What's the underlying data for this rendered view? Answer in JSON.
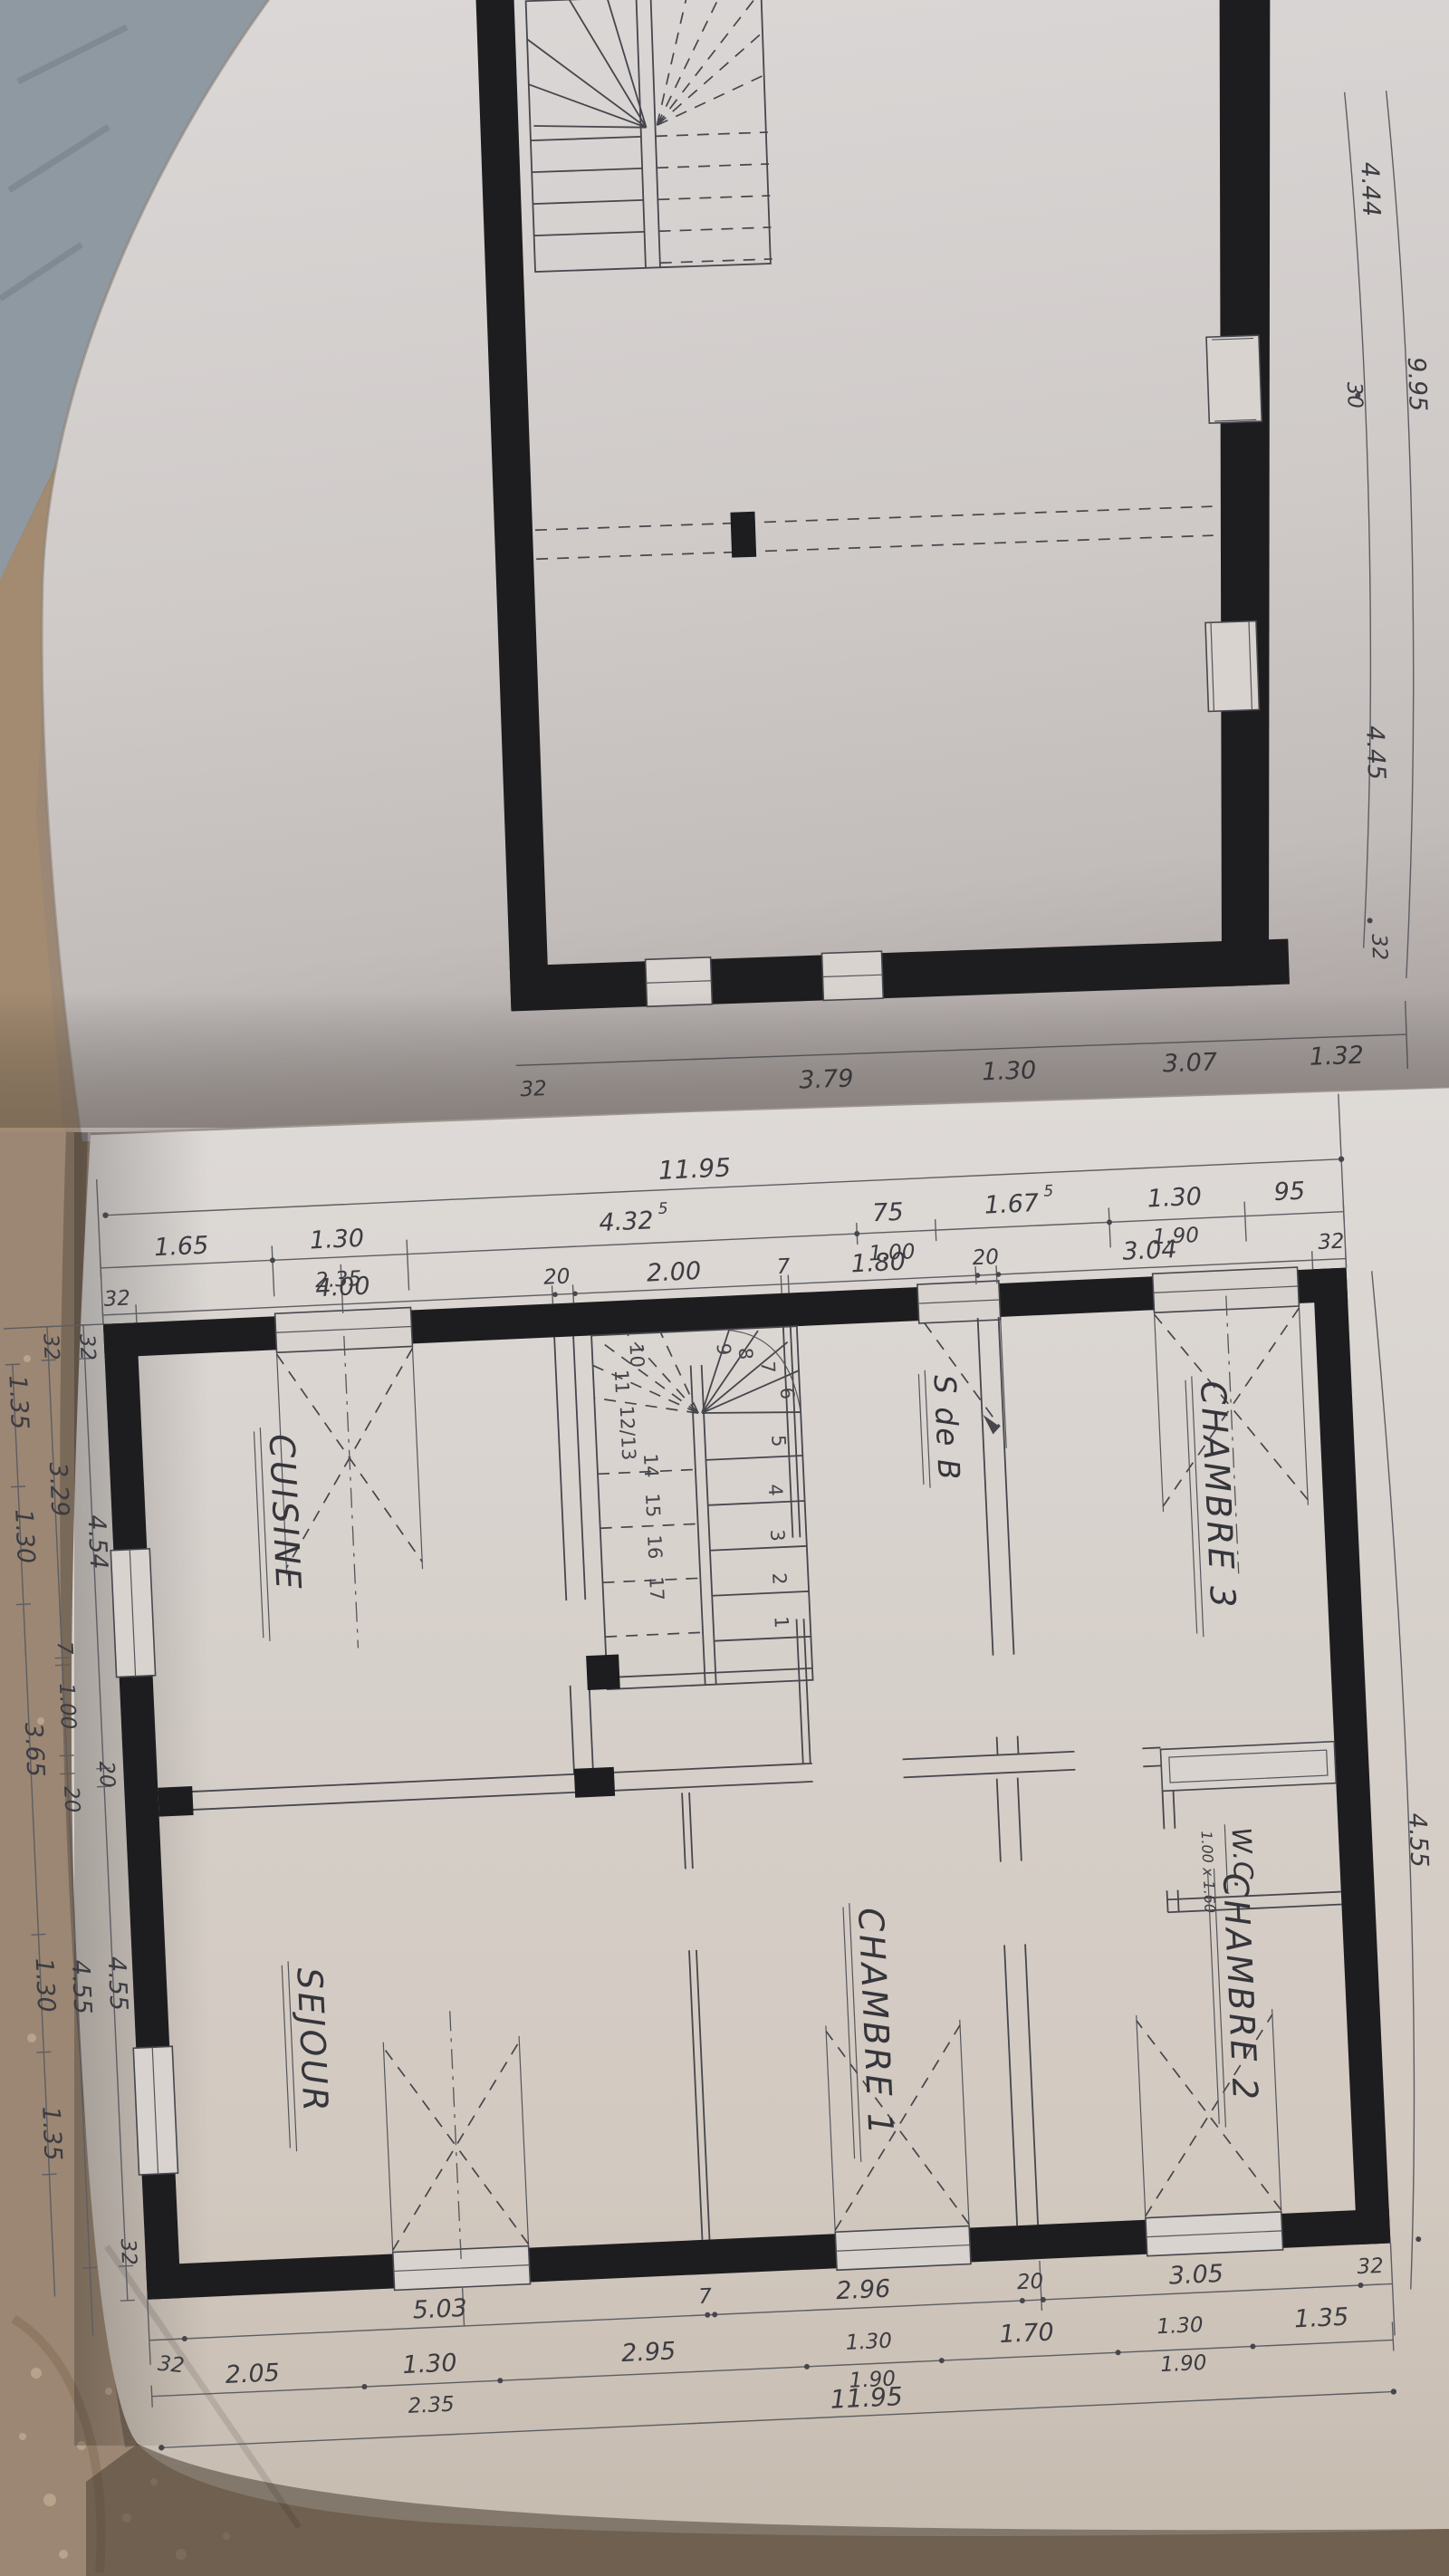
{
  "palette": {
    "paper": "#d8d3cf",
    "ink": "#3c3c42",
    "wall_black": "#1d1d1f",
    "carpet_tan": "#9b8773",
    "carpet_blue": "#8e99a2"
  },
  "upper_plan": {
    "right_dims": [
      "4.44",
      "30",
      "4.45",
      "32"
    ],
    "right_total": "9.95",
    "bottom_dims": [
      "32",
      "3.79",
      "1.30",
      "3.07",
      "1.32"
    ]
  },
  "plan": {
    "top_total": "11.95",
    "bottom_total": "11.95",
    "top_row2": [
      {
        "t": "1.65"
      },
      {
        "t": "1.30",
        "b": "2.35"
      },
      {
        "t": "4.32",
        "sup": "5"
      },
      {
        "t": "75",
        "b": "1.00"
      },
      {
        "t": "1.67",
        "sup": "5"
      },
      {
        "t": "1.30",
        "b": "1.90"
      },
      {
        "t": "95"
      }
    ],
    "top_row3": [
      "32",
      "4.00",
      "20",
      "2.00",
      "7",
      "1.80",
      "20",
      "3.04",
      "32"
    ],
    "bottom_row1": [
      "32",
      "5.03",
      "7",
      "2.96",
      "20",
      "3.05",
      "32"
    ],
    "bottom_row2": [
      {
        "t": "2.05"
      },
      {
        "t": "1.30",
        "b": "2.35"
      },
      {
        "t": "2.95"
      },
      {
        "t": "1.30",
        "b": "1.90"
      },
      {
        "t": "1.70"
      },
      {
        "t": "1.30",
        "b": "1.90"
      },
      {
        "t": "1.35"
      }
    ],
    "left_inner": [
      "32",
      "4.54",
      "20",
      "4.55",
      "32"
    ],
    "left_mid": [
      "32",
      "3.29",
      "7",
      "1.00",
      "20",
      "4.55"
    ],
    "left_outer": [
      "1.35",
      "1.30",
      "3.65",
      "1.30",
      "1.35"
    ],
    "right_dim": "4.55",
    "rooms": {
      "cuisine": "CUISINE",
      "sejour": "SEJOUR",
      "sdb": "S de B",
      "wc": "W.C.",
      "wc_size": "1.00 x 1.60",
      "chambre1": "CHAMBRE 1",
      "chambre2": "CHAMBRE 2",
      "chambre3": "CHAMBRE 3"
    },
    "stairs": [
      "1",
      "2",
      "3",
      "4",
      "5",
      "6",
      "7",
      "8",
      "9",
      "10",
      "11",
      "12/13",
      "14",
      "15",
      "16",
      "17"
    ]
  }
}
